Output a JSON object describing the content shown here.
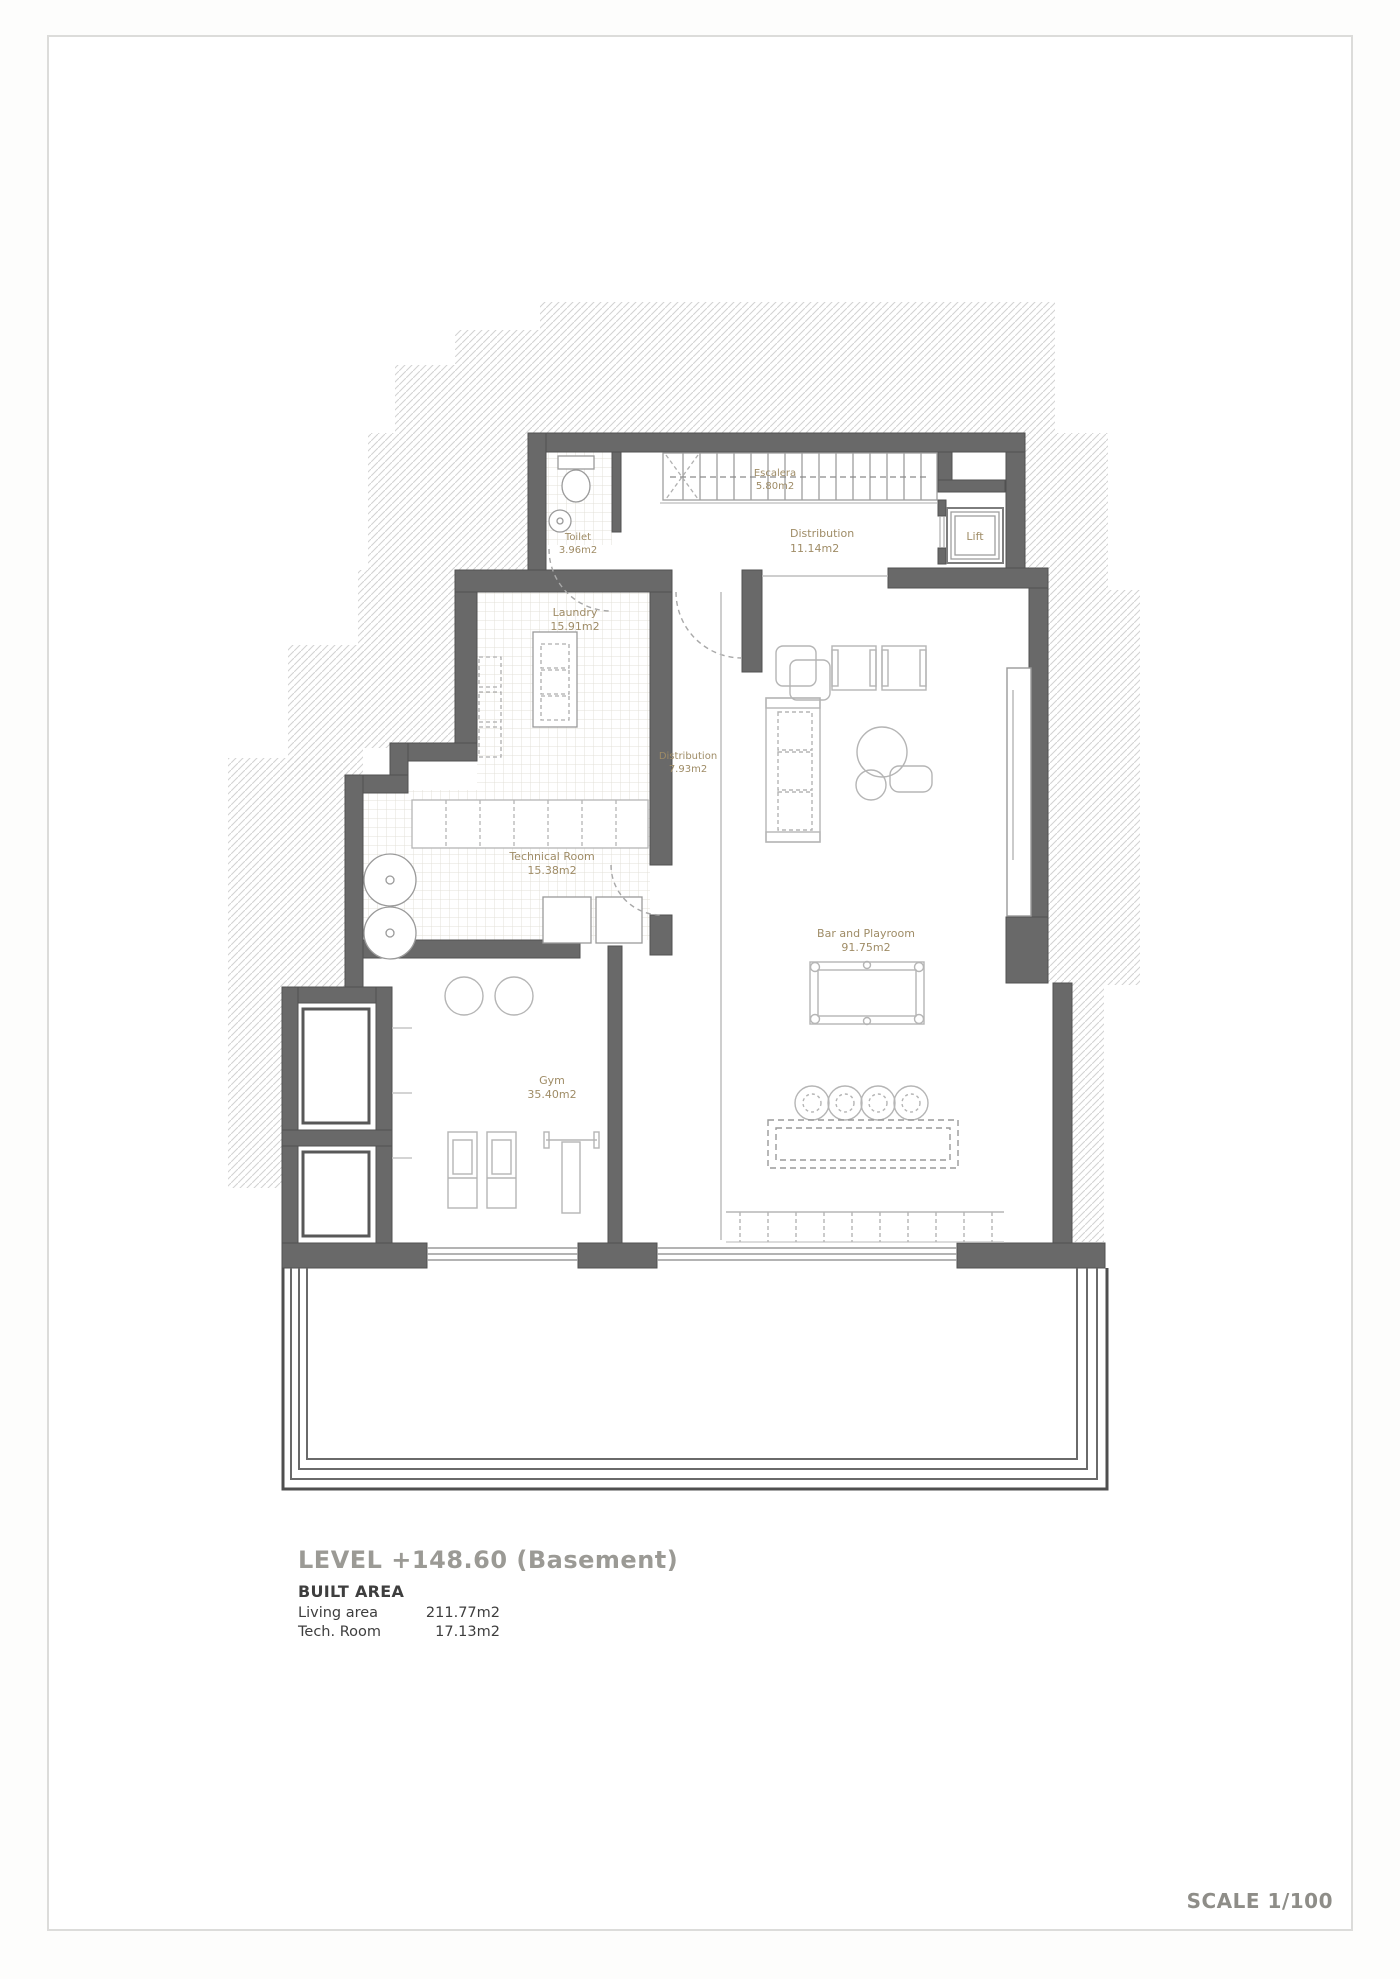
{
  "drawing": {
    "title": "LEVEL +148.60 (Basement)",
    "built_area_heading": "BUILT AREA",
    "area_rows": [
      {
        "label": "Living area",
        "value": "211.77m2"
      },
      {
        "label": "Tech. Room",
        "value": "17.13m2"
      }
    ],
    "scale_label": "SCALE 1/100"
  },
  "rooms": [
    {
      "name": "Toilet",
      "area": "3.96m2"
    },
    {
      "name": "Escalera",
      "area": "5.80m2"
    },
    {
      "name": "Distribution",
      "area": "11.14m2"
    },
    {
      "name": "Lift",
      "area": ""
    },
    {
      "name": "Laundry",
      "area": "15.91m2"
    },
    {
      "name": "Distribution",
      "area": "7.93m2"
    },
    {
      "name": "Technical Room",
      "area": "15.38m2"
    },
    {
      "name": "Gym",
      "area": "35.40m2"
    },
    {
      "name": "Bar and Playroom",
      "area": "91.75m2"
    }
  ],
  "colors": {
    "wall": "#696969",
    "room_label": "#9f8c66",
    "title_gray": "#9b9a95",
    "hatch_line": "#d3d3d3"
  }
}
